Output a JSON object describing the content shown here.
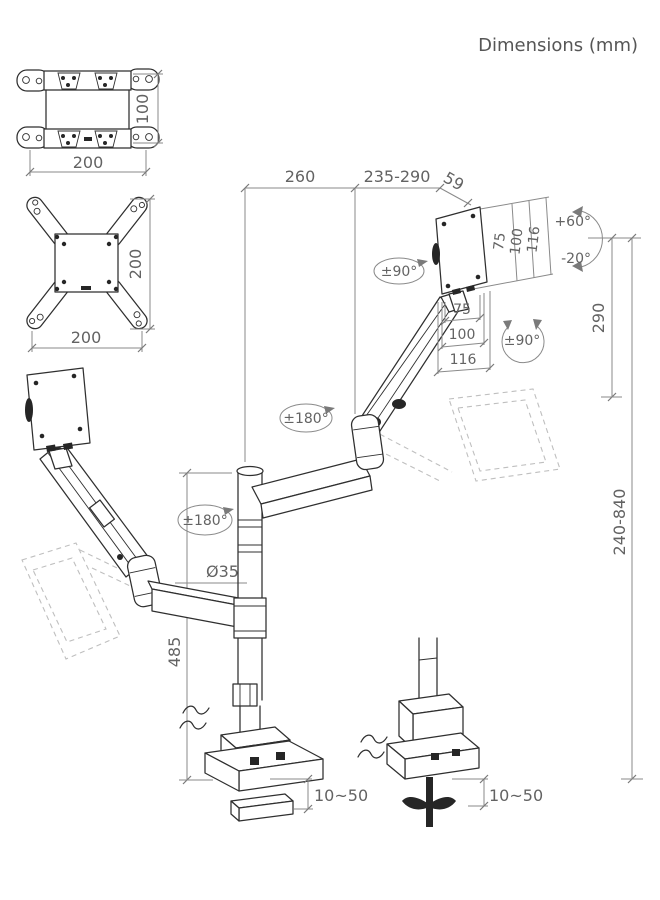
{
  "title": "Dimensions (mm)",
  "vesa_adapter": {
    "height": "100",
    "width": "200"
  },
  "vesa_x_adapter": {
    "height": "200",
    "width": "200"
  },
  "arm_reach": {
    "rear": "260",
    "front": "235-290",
    "head_offset": "59"
  },
  "head_plate": {
    "vertical_dims": [
      "75",
      "100",
      "116"
    ],
    "horizontal_dims": [
      "75",
      "100",
      "116"
    ]
  },
  "angles": {
    "tilt_up": "+60°",
    "tilt_down": "-20°",
    "head_swivel": "±90°",
    "screen_rotation": "±90°",
    "upper_arm_swivel": "±180°",
    "lower_arm_swivel": "±180°"
  },
  "heights": {
    "riser": "290",
    "adjustment_range": "240-840",
    "column": "485"
  },
  "pole": {
    "diameter": "Ø35"
  },
  "desk_mount": {
    "clamp_thickness": "10~50",
    "grommet_thickness": "10~50"
  },
  "colors": {
    "drawing_line": "#2f2f2f",
    "dimension_line": "#8a8a8a",
    "label_text": "#636363",
    "ghost_line": "#bfbfbf",
    "background": "#ffffff"
  }
}
